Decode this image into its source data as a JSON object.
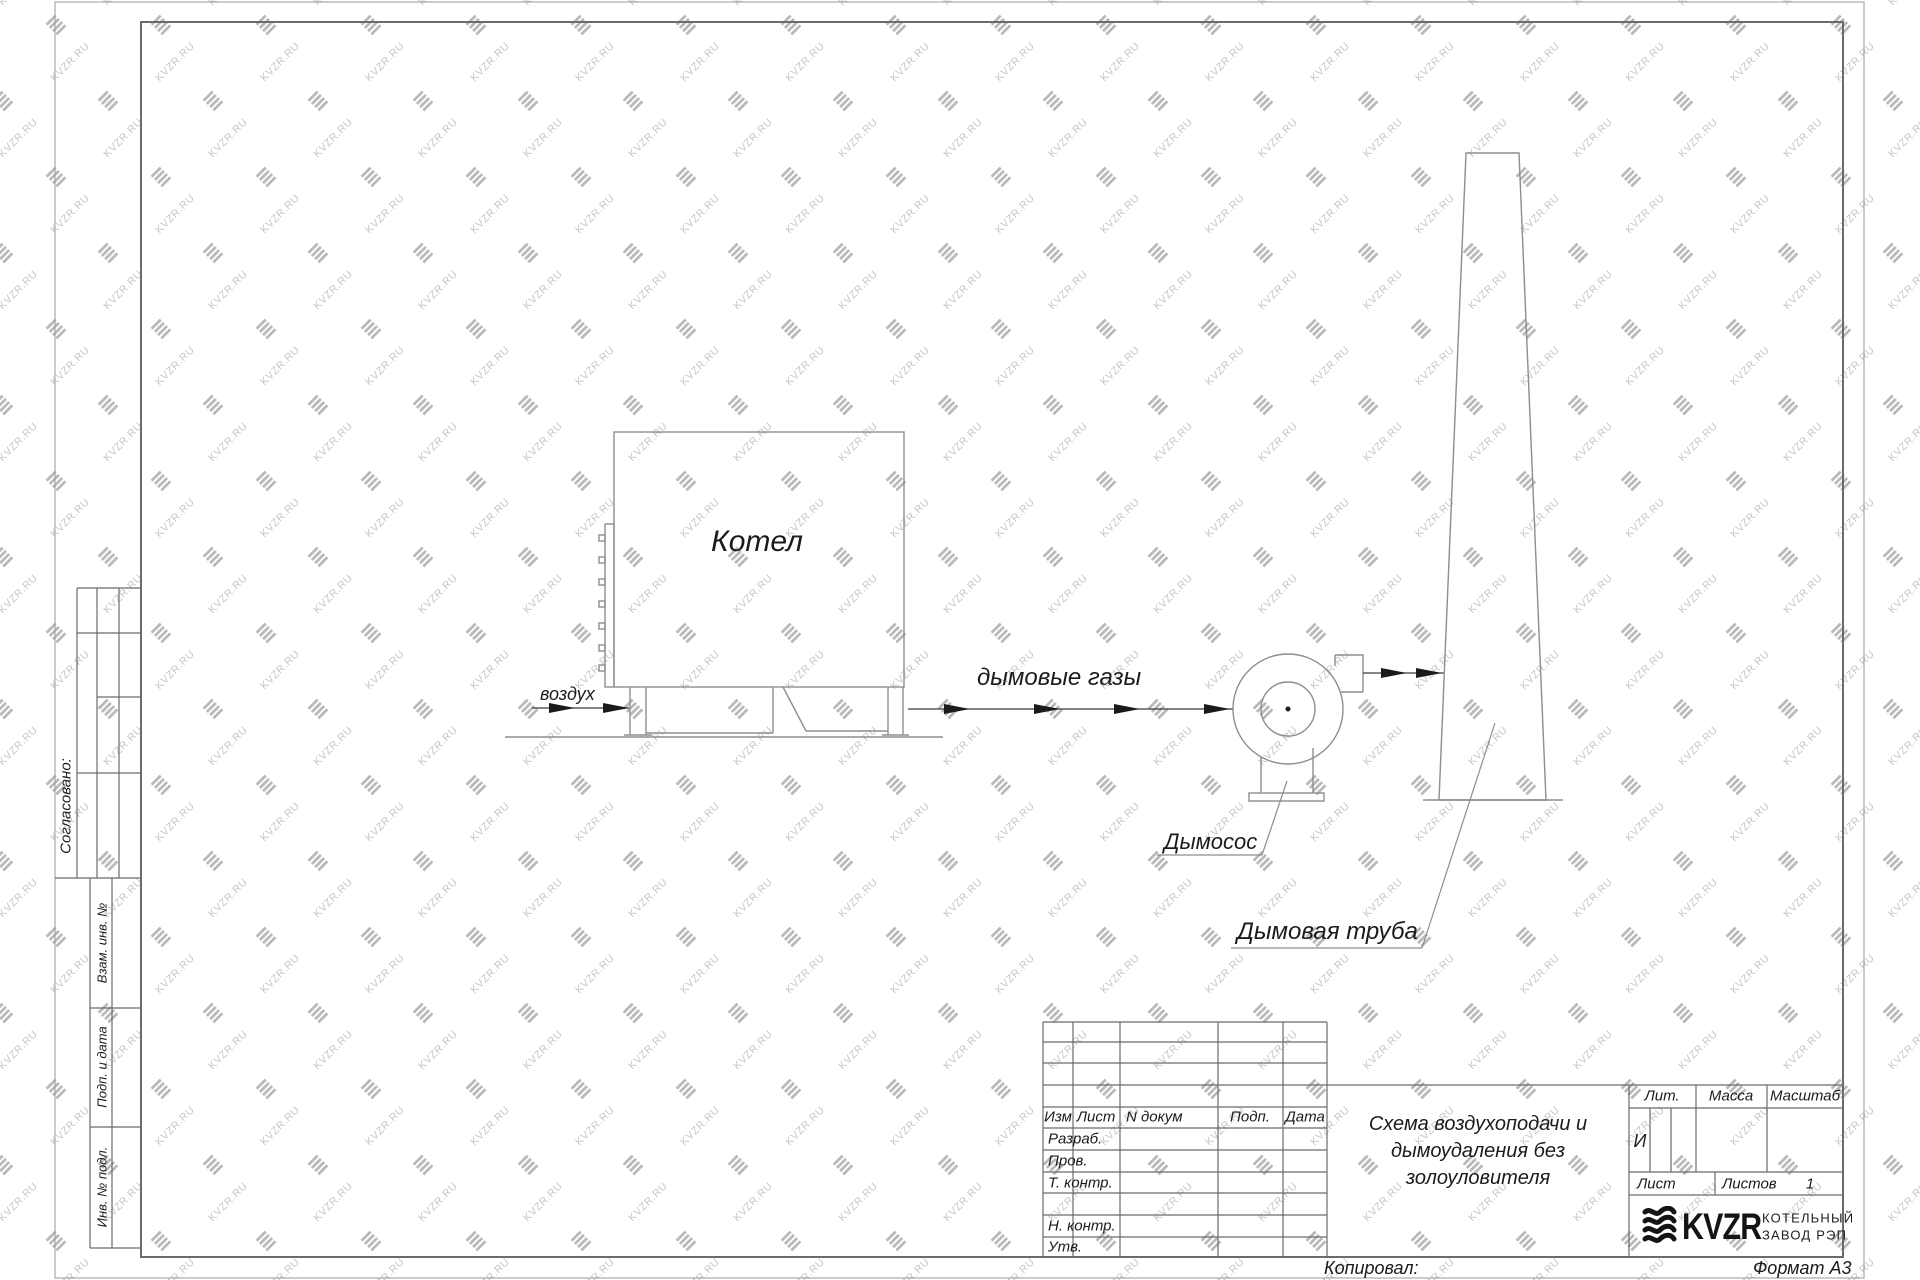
{
  "theme": {
    "ink": "#1b1b1b",
    "drawing_line": "#8e8e8e",
    "frame_line": "#6b6b6b",
    "watermark_text_color": "#c6c6c6",
    "watermark_glyph_color": "#b9b9b9"
  },
  "watermark": {
    "text": "KVZR.RU"
  },
  "drawing": {
    "boiler_label": "Котел",
    "air_label": "воздух",
    "flue_gas_label": "дымовые газы",
    "fan_label": "Дымосос",
    "chimney_label": "Дымовая труба"
  },
  "side_panel": {
    "agreed_label": "Согласовано:",
    "vzam_label": "Взам. инв. №",
    "podp_label": "Подп. и дата",
    "inv_label": "Инв. № подл."
  },
  "title_block": {
    "header": {
      "izm": "Изм",
      "list": "Лист",
      "doc": "N докум",
      "podp": "Подп.",
      "data": "Дата"
    },
    "rows": [
      "Разраб.",
      "Пров.",
      "Т. контр.",
      "",
      "Н. контр.",
      "Утв."
    ],
    "title_line1": "Схема воздухоподачи и",
    "title_line2": "дымоудаления без",
    "title_line3": "золоуловителя",
    "lit_label": "Лит.",
    "massa_label": "Масса",
    "masshtab_label": "Масштаб",
    "lit_value": "И",
    "list_label": "Лист",
    "listov_label": "Листов",
    "listov_value": "1",
    "company": {
      "logo_text": "KVZR",
      "name_line1": "КОТЕЛЬНЫЙ",
      "name_line2": "ЗАВОД РЭП"
    }
  },
  "footer": {
    "copied_label": "Копировал:",
    "format_label": "Формат А3"
  }
}
